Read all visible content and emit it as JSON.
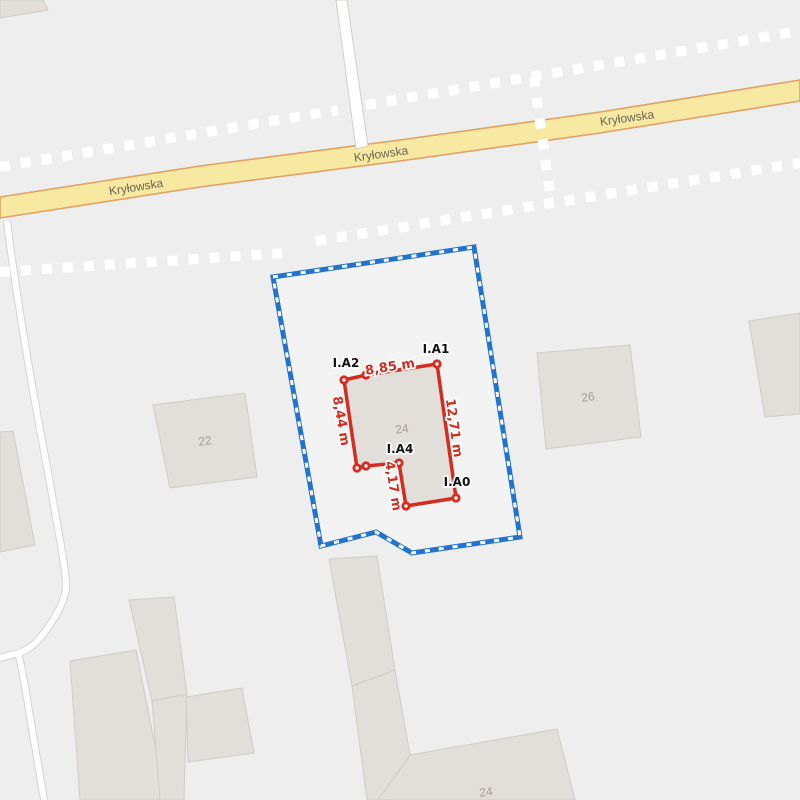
{
  "road": {
    "name": "Kryłowska"
  },
  "buildings": {
    "left_number": "22",
    "measured_number": "24",
    "right_number": "26",
    "bottom_number": "24"
  },
  "measurement": {
    "points": {
      "a0": "I.A0",
      "a1": "I.A1",
      "a2": "I.A2",
      "a4": "I.A4"
    },
    "distances": {
      "top": "8,85 m",
      "left": "8,44 m",
      "right": "12,71 m",
      "bottom_left": "4,17 m"
    }
  },
  "colors": {
    "bg": "#eeeeee",
    "building-fill": "#e2dfda",
    "building-stroke": "#cfccc6",
    "building-label": "#a29c93",
    "road-fill": "#f8e9a2",
    "road-stroke": "#dfa263",
    "road-label": "#6b6456",
    "parcel-blue": "#2272cf",
    "measure-red": "#d62c20",
    "point-label": "#111111"
  }
}
